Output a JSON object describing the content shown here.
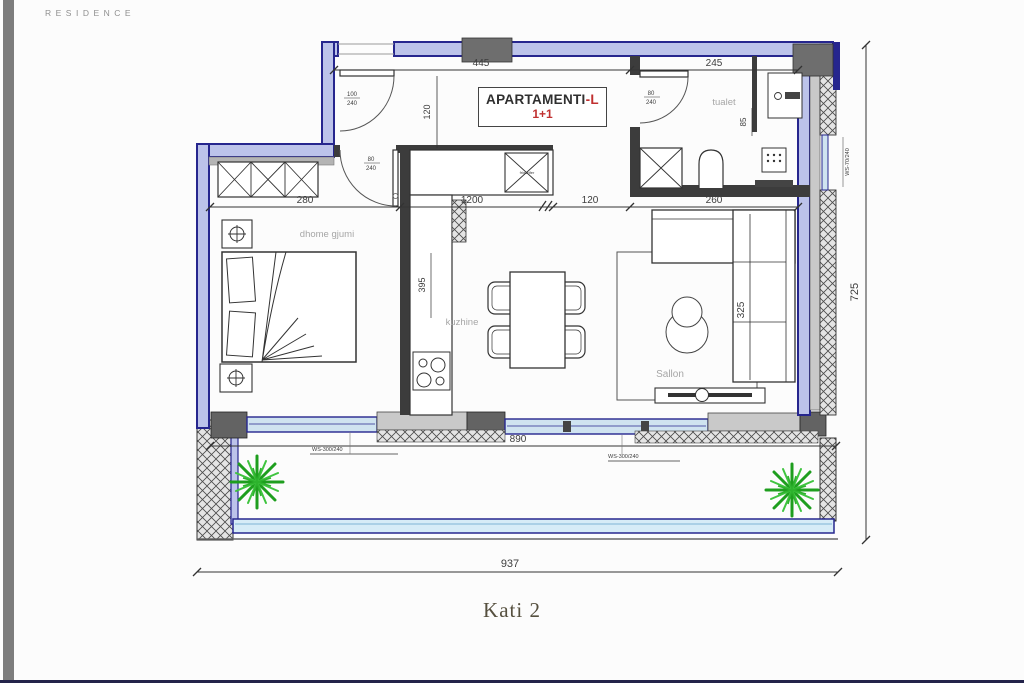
{
  "brand": "RESIDENCE",
  "caption": "Kati 2",
  "title_block": {
    "name": "APARTAMENTI",
    "suffix": "-L",
    "unit_type": "1+1"
  },
  "rooms": {
    "bedroom": "dhome gjumi",
    "kitchen": "kuzhine",
    "toilet": "tualet",
    "living": "Sallon"
  },
  "appliances": {
    "fridge": "frigorifer"
  },
  "dims": {
    "top_left": "445",
    "top_right": "245",
    "entry_height": "120",
    "bedroom_width": "280",
    "kitchen_width": "1200",
    "corridor_width": "120",
    "living_width": "260",
    "kitchen_depth": "395",
    "toilet_niche": "85",
    "sofa_depth": "325",
    "balcony_width": "890",
    "total_width": "937",
    "total_height": "725"
  },
  "openings": {
    "entry_door": {
      "w": "100",
      "h": "240"
    },
    "bedroom_door": {
      "w": "80",
      "h": "240"
    },
    "toilet_door": {
      "w": "80",
      "h": "240"
    },
    "window_bedroom": "WS-300/240",
    "window_living": "WS-300/240",
    "window_side": "WS-70/240"
  },
  "colors": {
    "wall": "#26268e",
    "wall_fill": "#bcc3ea",
    "glass": "#cfe3f0",
    "accent_red": "#c03030",
    "plant_green": "#2aa82a",
    "muted_text": "#a6a6a6"
  }
}
